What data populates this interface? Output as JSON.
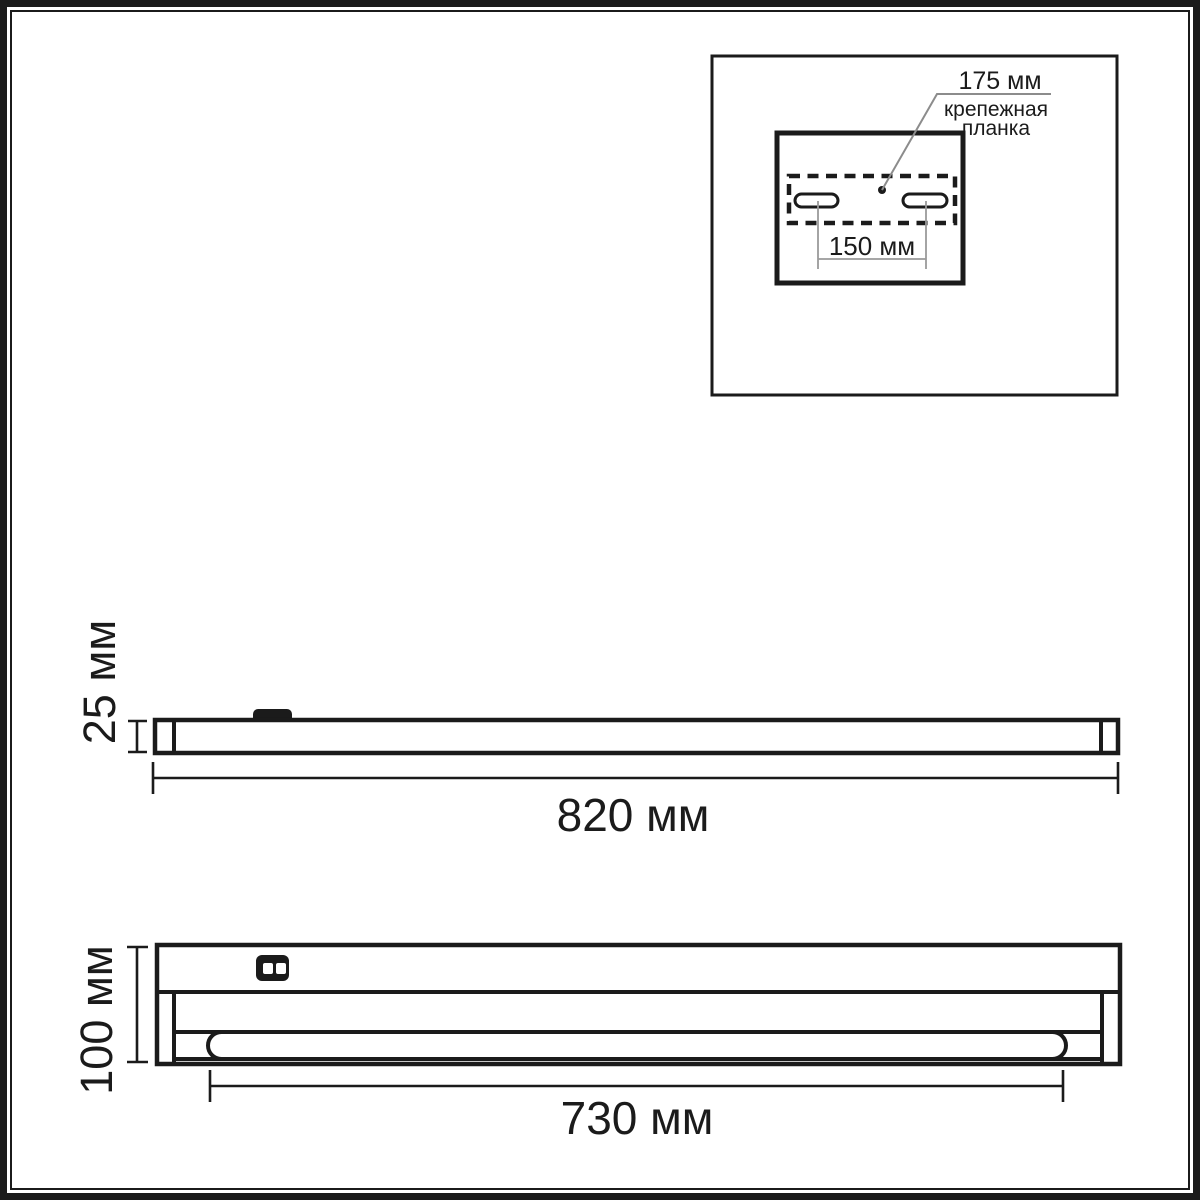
{
  "colors": {
    "line": "#1b1b1b",
    "leader": "#8c8c8c",
    "background": "#ffffff"
  },
  "inset": {
    "callout_value": "175 мм",
    "callout_name": "крепежная планка",
    "slot_spacing": "150 мм"
  },
  "side_view": {
    "height": "25 мм",
    "length": "820 мм"
  },
  "front_view": {
    "height": "100 мм",
    "lamp_length": "730 мм"
  }
}
